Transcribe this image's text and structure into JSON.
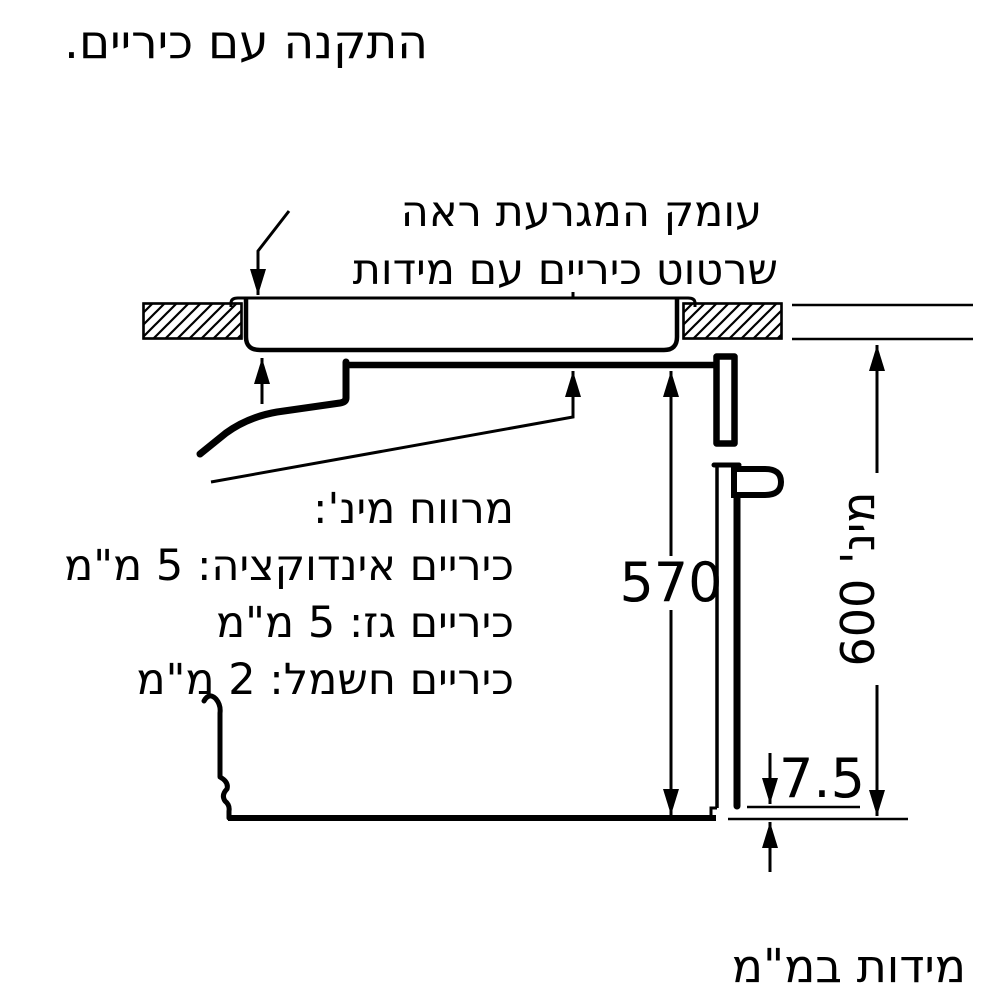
{
  "title": "התקנה עם כיריים.",
  "annotation": {
    "line1": "עומק המגרעת ראה",
    "line2": "שרטוט כיריים עם מידות"
  },
  "clearance_note": {
    "line1": "מרווח מינ':",
    "line2": "כיריים אינדוקציה: 5 מ\"מ",
    "line3": "כיריים גז: 5 מ\"מ",
    "line4": "כיריים חשמל: 2 מ\"מ"
  },
  "dimensions": {
    "oven_niche_height": "570",
    "min_cabinet_height": "מינ' 600",
    "door_bottom_gap": "7.5"
  },
  "footer_note": "מידות במ\"מ",
  "colors": {
    "line": "#000000",
    "background": "#ffffff"
  }
}
